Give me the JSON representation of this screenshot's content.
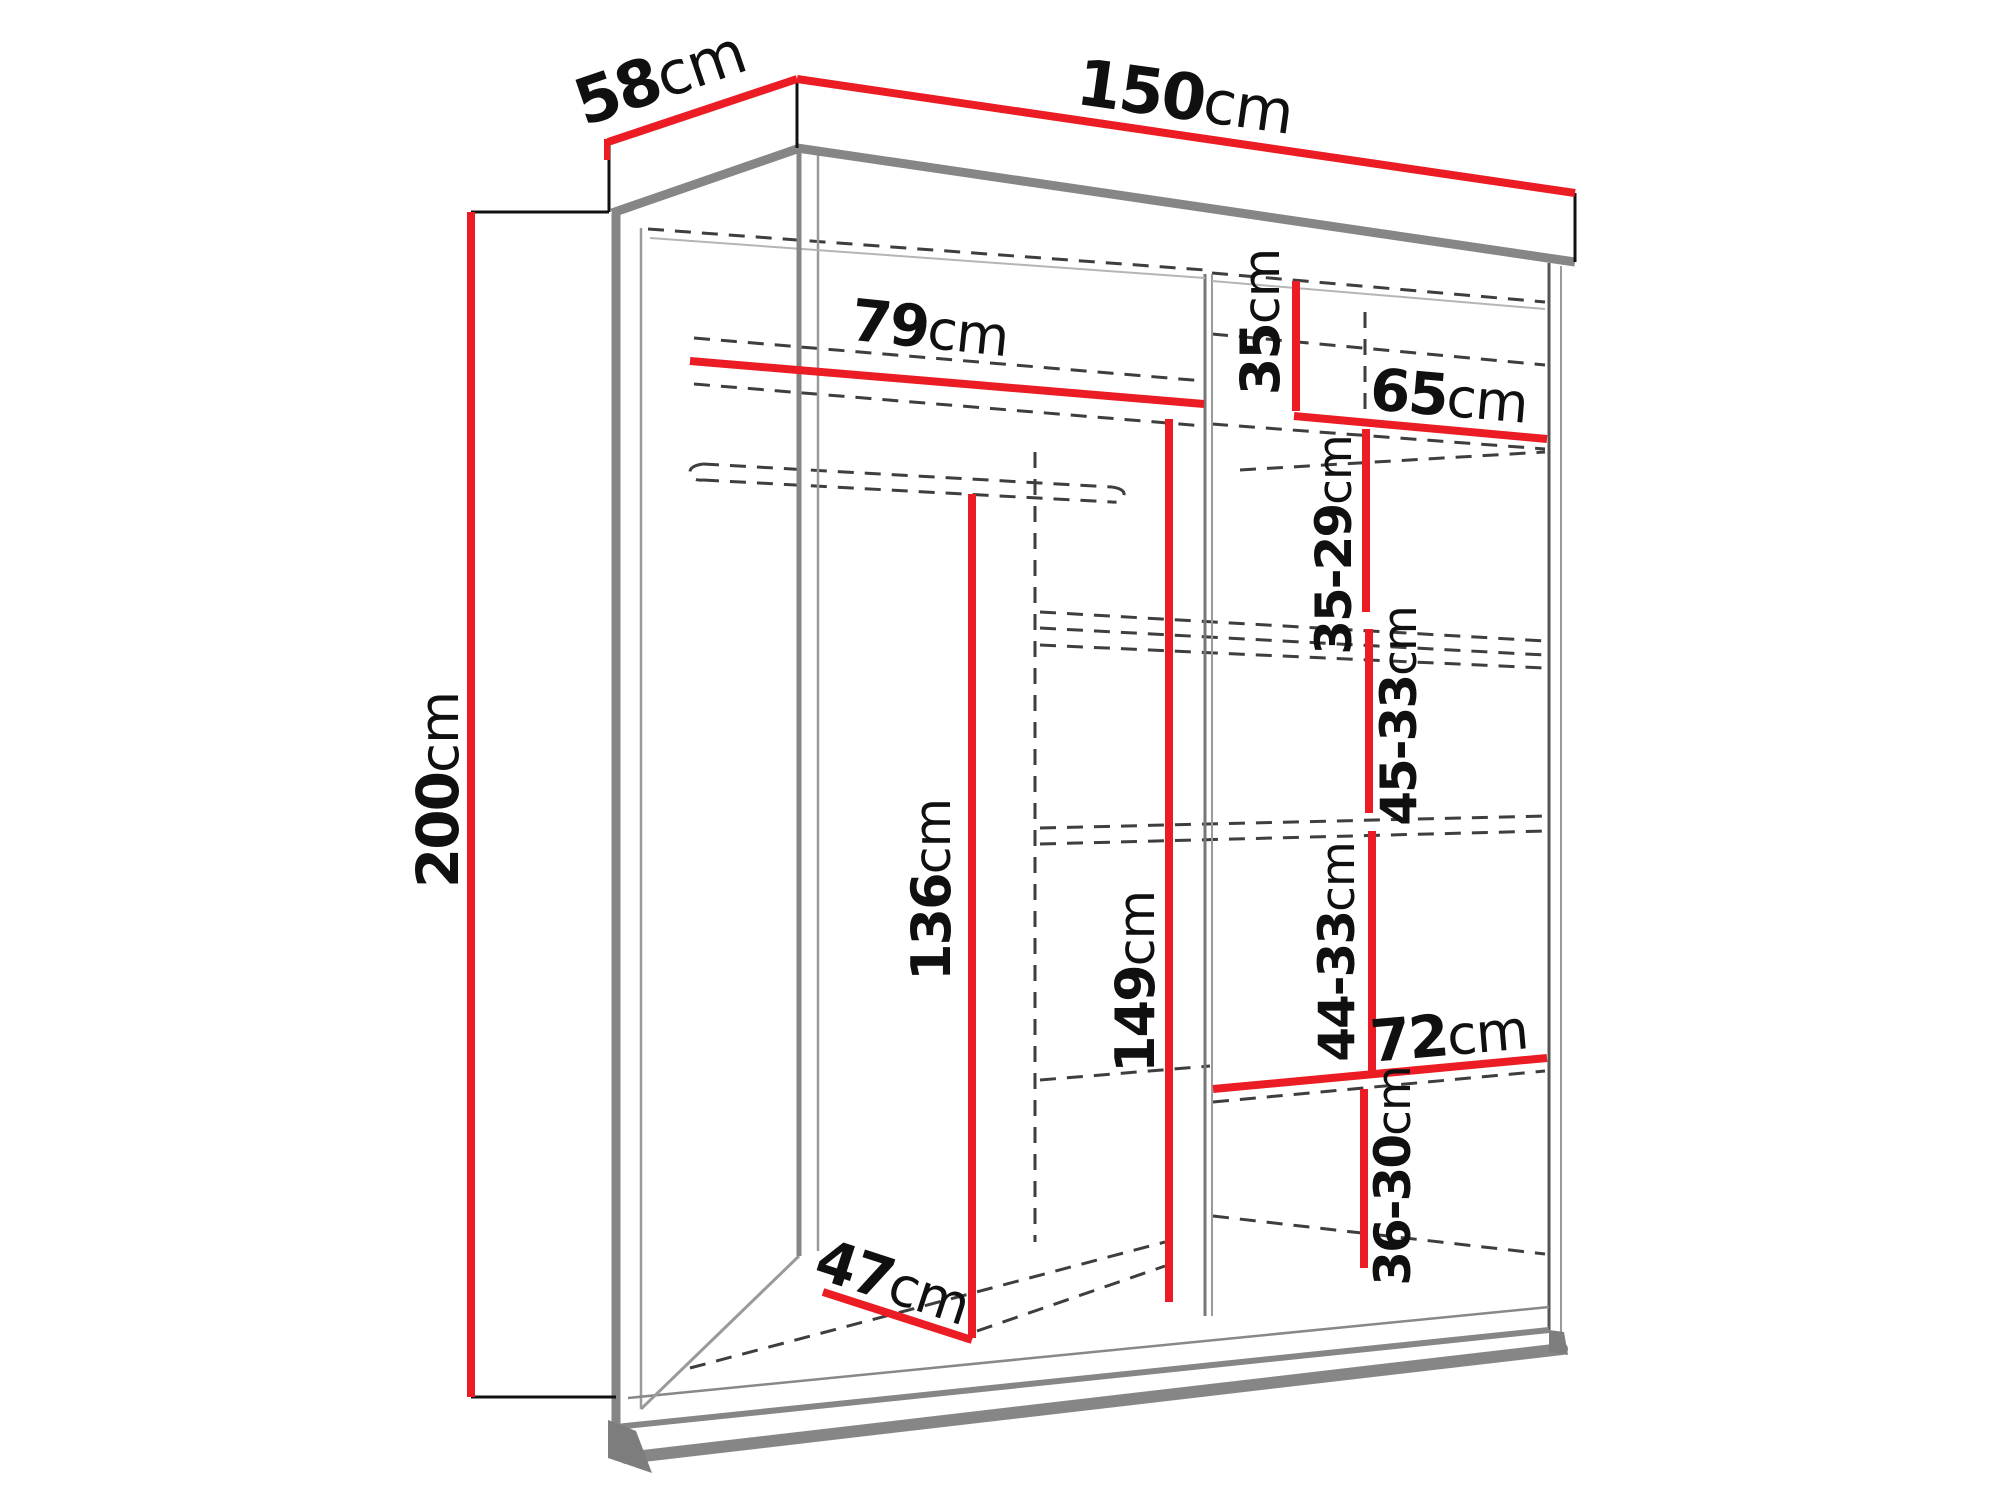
{
  "diagram": {
    "type": "furniture-dimension-diagram",
    "subject": "two-door sliding wardrobe with interior shelf dimensions",
    "unit": "cm",
    "colors": {
      "dimension_line": "#ec1c24",
      "structure_gray": "#868686",
      "outline_black": "#111111",
      "hidden_edge_dashed": "#3e3e3e",
      "background": "#ffffff"
    },
    "labels": {
      "width": {
        "value": "150",
        "unit": "cm"
      },
      "depth": {
        "value": "58",
        "unit": "cm"
      },
      "height": {
        "value": "200",
        "unit": "cm"
      },
      "left_compartment_width": {
        "value": "79",
        "unit": "cm"
      },
      "top_shelf_height": {
        "value": "35",
        "unit": "cm"
      },
      "right_shelf_width": {
        "value": "65",
        "unit": "cm"
      },
      "shelf_spacing_1": {
        "value": "35-29",
        "unit": "cm"
      },
      "shelf_spacing_2": {
        "value": "45-33",
        "unit": "cm"
      },
      "shelf_spacing_3": {
        "value": "44-33",
        "unit": "cm"
      },
      "bottom_shelf_width": {
        "value": "72",
        "unit": "cm"
      },
      "shelf_spacing_4": {
        "value": "36-30",
        "unit": "cm"
      },
      "hanging_space_height": {
        "value": "136",
        "unit": "cm"
      },
      "left_section_height": {
        "value": "149",
        "unit": "cm"
      },
      "interior_floor_depth": {
        "value": "47",
        "unit": "cm"
      }
    }
  }
}
